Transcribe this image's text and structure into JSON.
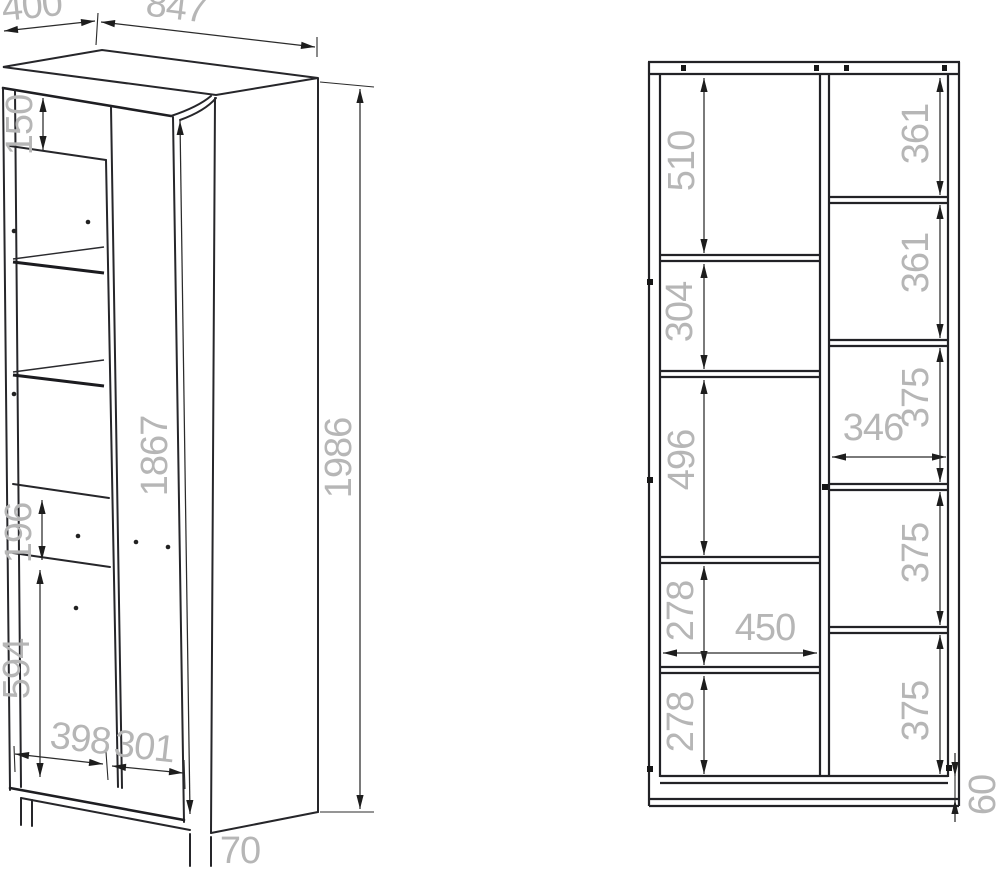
{
  "drawing": {
    "title": "wardrobe-technical-drawing",
    "left_view": {
      "depth": "400",
      "width": "847",
      "top_rail_height": "150",
      "door_height": "1867",
      "total_height": "1986",
      "drawer_height": "196",
      "lower_door_height": "594",
      "left_door_width": "398",
      "right_door_width": "301",
      "leg_height": "70"
    },
    "right_view": {
      "left_sections": [
        "510",
        "304",
        "496",
        "278",
        "278"
      ],
      "right_sections": [
        "361",
        "361",
        "375",
        "375",
        "375"
      ],
      "left_inner_width": "450",
      "right_inner_width": "346",
      "plinth_height": "60"
    }
  }
}
